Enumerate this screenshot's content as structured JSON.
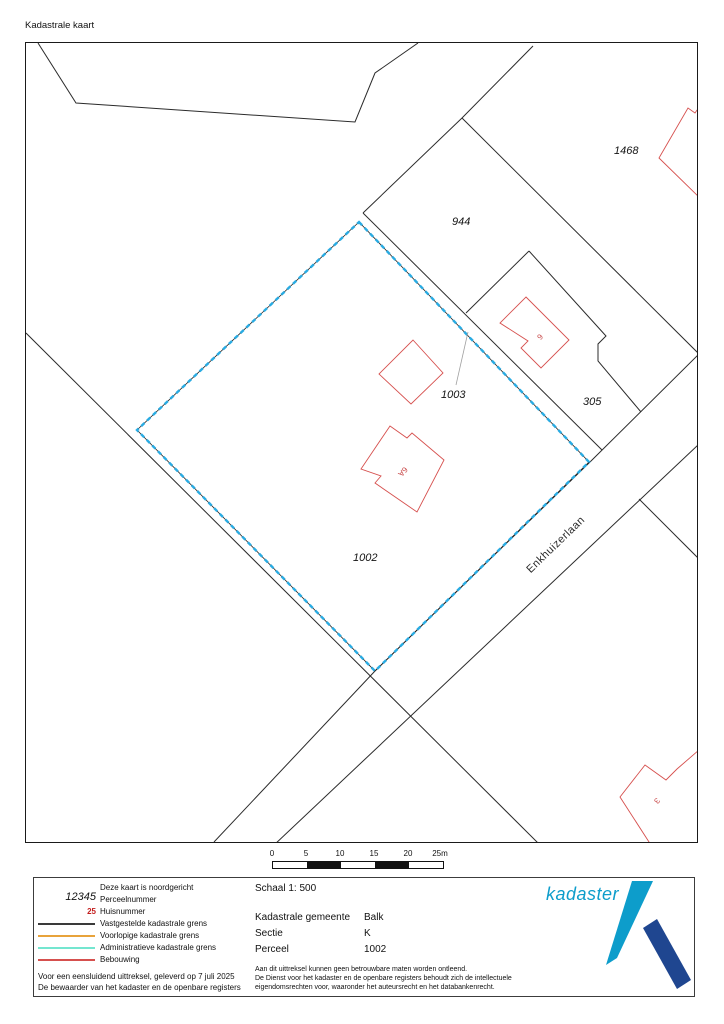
{
  "page": {
    "title": "Kadastrale kaart"
  },
  "map": {
    "parcels": [
      {
        "number": "1468"
      },
      {
        "number": "944"
      },
      {
        "number": "1003"
      },
      {
        "number": "305"
      },
      {
        "number": "1002"
      }
    ],
    "houses": [
      {
        "number": "6"
      },
      {
        "number": "6A"
      },
      {
        "number": "3"
      }
    ],
    "street": "Enkhuizerlaan",
    "highlighted_parcel": "1002"
  },
  "scalebar": {
    "ticks": [
      "0",
      "5",
      "10",
      "15",
      "20",
      "25m"
    ]
  },
  "legend": {
    "north_note": "Deze kaart is noordgericht",
    "perceelnummer_symbol": "12345",
    "perceelnummer_label": "Perceelnummer",
    "huisnummer_symbol": "25",
    "huisnummer_label": "Huisnummer",
    "line_items": [
      {
        "label": "Vastgestelde kadastrale grens",
        "color": "#3a3a3a"
      },
      {
        "label": "Voorlopige kadastrale grens",
        "color": "#e8a33b"
      },
      {
        "label": "Administratieve kadastrale grens",
        "color": "#74e6d0"
      },
      {
        "label": "Bebouwing",
        "color": "#d6504e"
      }
    ],
    "footnote_line1": "Voor een eensluidend uittreksel, geleverd op 7 juli 2025",
    "footnote_line2": "De bewaarder van het kadaster en de openbare registers"
  },
  "info": {
    "scale": "Schaal 1: 500",
    "rows": [
      {
        "label": "Kadastrale gemeente",
        "value": "Balk"
      },
      {
        "label": "Sectie",
        "value": "K"
      },
      {
        "label": "Perceel",
        "value": "1002"
      }
    ],
    "disclaimer_line1": "Aan dit uittreksel kunnen geen betrouwbare maten worden ontleend.",
    "disclaimer_line2": "De Dienst voor het kadaster en de openbare registers behoudt zich de intellectuele",
    "disclaimer_line3": "eigendomsrechten voor, waaronder het auteursrecht en het databankenrecht.",
    "disclaimer_full": "Aan dit uittreksel kunnen geen betrouwbare maten worden ontleend. De Dienst voor het kadaster en de openbare registers behoudt zich de intellectuele eigendomsrechten voor, waaronder het auteursrecht en het databankenrecht."
  },
  "logo": {
    "wordmark": "kadaster"
  },
  "colors": {
    "administrative_boundary_map_dashes": "#29abe2",
    "established_boundary": "#3a3a3a",
    "provisional_boundary": "#e8a33b",
    "administrative_boundary_legend": "#74e6d0",
    "building_outline": "#d6504e",
    "logo_light_blue": "#0d9dcb",
    "logo_dark_blue": "#1f4690"
  }
}
